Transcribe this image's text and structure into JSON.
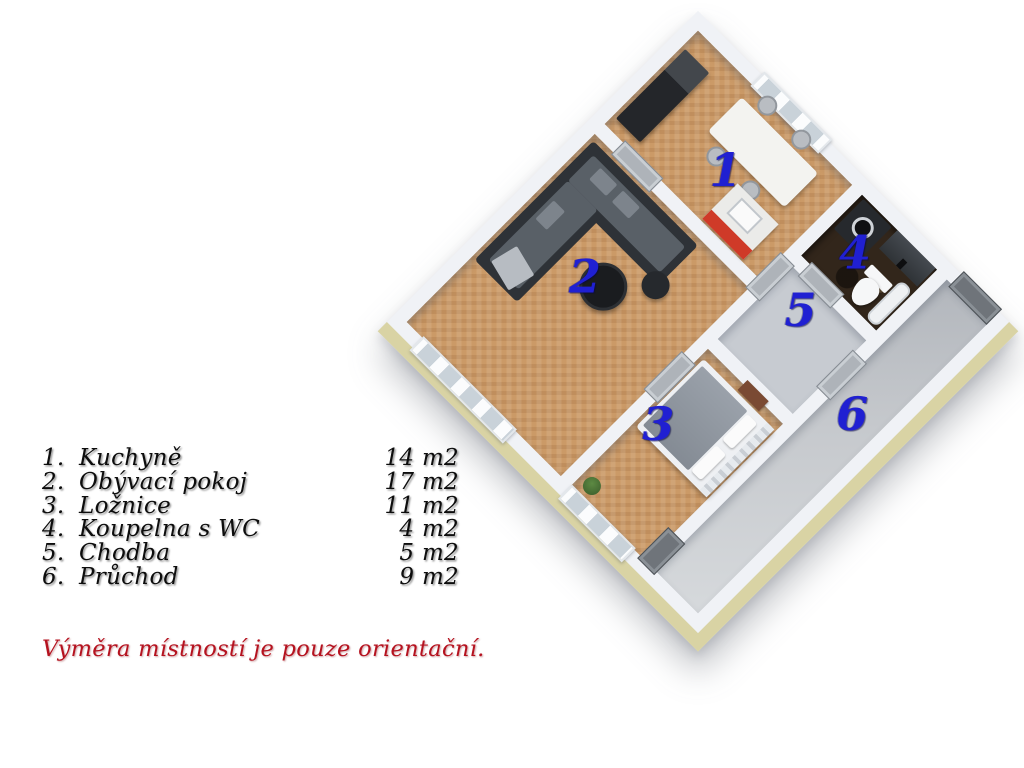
{
  "legend": {
    "rows": [
      {
        "num": "1.",
        "name": "Kuchyně",
        "area": "14 m2"
      },
      {
        "num": "2.",
        "name": "Obývací pokoj",
        "area": "17 m2"
      },
      {
        "num": "3.",
        "name": "Ložnice",
        "area": "11 m2"
      },
      {
        "num": "4.",
        "name": "Koupelna s WC",
        "area": "4 m2"
      },
      {
        "num": "5.",
        "name": "Chodba",
        "area": "5 m2"
      },
      {
        "num": "6.",
        "name": "Průchod",
        "area": "9 m2"
      }
    ]
  },
  "plan": {
    "room_labels": [
      "1",
      "2",
      "3",
      "4",
      "5",
      "6"
    ],
    "rooms": [
      {
        "number": "1",
        "name": "Kuchyně"
      },
      {
        "number": "2",
        "name": "Obývací pokoj"
      },
      {
        "number": "3",
        "name": "Ložnice"
      },
      {
        "number": "4",
        "name": "Koupelna s WC"
      },
      {
        "number": "5",
        "name": "Chodba"
      },
      {
        "number": "6",
        "name": "Průchod"
      }
    ]
  },
  "disclaimer": "Výměra místností je pouze orientační.",
  "colors": {
    "room_label_blue": "#2020d2",
    "disclaimer_red": "#b5121f",
    "wood_floor": "#cb9a67",
    "wall_white": "#f0f2f6",
    "outer_band_khaki": "#d9d3a4",
    "hall_gray": "#c7cbd1",
    "bath_marble": "#32261b",
    "kitchen_counter_red": "#cf3a28"
  }
}
